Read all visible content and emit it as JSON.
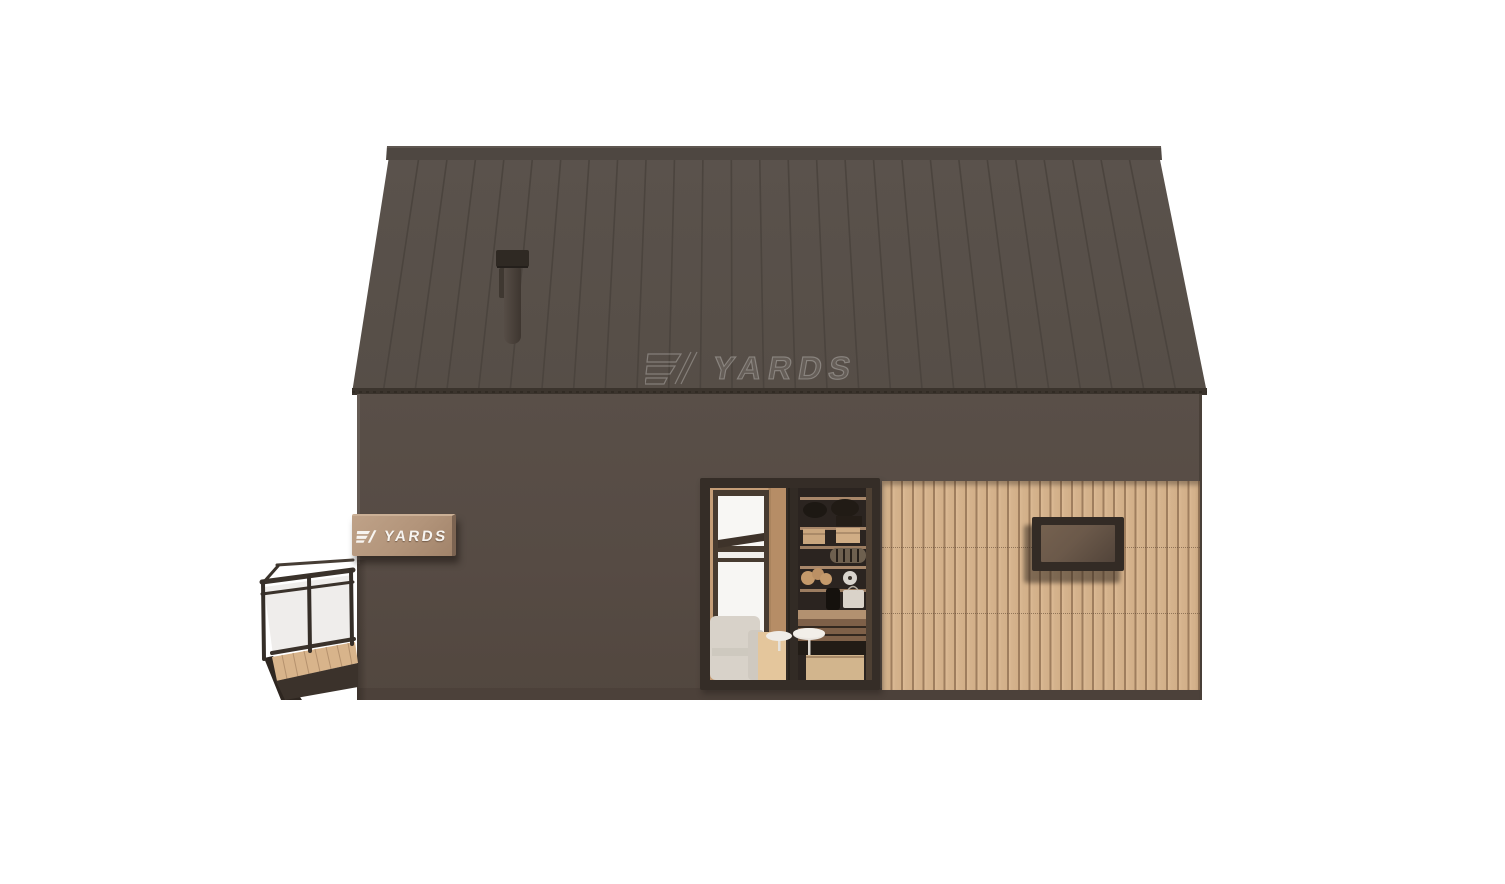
{
  "scene": {
    "title": "3D exterior render of a dark barn-style modular cabin with wood slat cladding, glass sliding doors, side deck and roof chimney",
    "background_color": "#ffffff"
  },
  "branding": {
    "plaque_label": "YARDS",
    "watermark_label": "YARDS",
    "plaque_icon": "yards-logo-icon",
    "watermark_icon": "yards-logo-outline-icon"
  },
  "palette": {
    "roof": "#58504a",
    "roof_seam": "#4b443e",
    "roof_ridge": "#4e4741",
    "wall": "#564b44",
    "wood_cladding": "#d5b28b",
    "cladding_gap": "#9f7e5e",
    "window_frame_dark": "#342c26",
    "window_glass_brown": "#6b594a",
    "plaque_wood": "#b2947a",
    "plaque_text": "#f7f4f0",
    "watermark_outline": "rgba(255,255,255,0.30)",
    "deck_wood": "#d8b48b",
    "railing_metal": "#3a322b",
    "railing_glass": "#ebe9e6",
    "interior_wall_wood": "#c49d77",
    "interior_floor": "#e4c69c",
    "armchair_fabric": "#d8d2c9",
    "shelf_background": "#2b2420",
    "shelf_wood": "#a8876a"
  }
}
